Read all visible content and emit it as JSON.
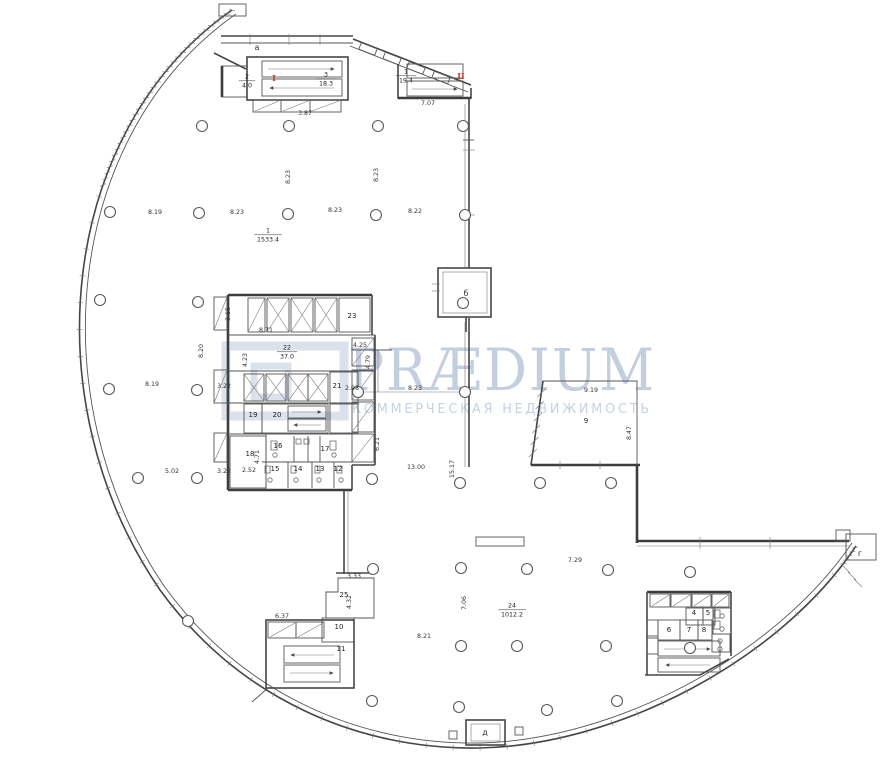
{
  "watermark": {
    "brand": "PRÆDIUM",
    "tagline": "КОММЕРЧЕСКАЯ НЕДВИЖИМОСТЬ",
    "color": "#b9c6da"
  },
  "plan": {
    "letters": [
      {
        "text": "а",
        "x": 257,
        "y": 50
      },
      {
        "text": "б",
        "x": 466,
        "y": 296
      },
      {
        "text": "г",
        "x": 860,
        "y": 556
      },
      {
        "text": "д",
        "x": 485,
        "y": 735
      }
    ],
    "red_markers": [
      {
        "text": "I",
        "x": 274,
        "y": 81
      },
      {
        "text": "II",
        "x": 461,
        "y": 79
      }
    ],
    "rooms": [
      {
        "num": "23",
        "x": 352,
        "y": 318
      },
      {
        "num": "21",
        "x": 337,
        "y": 388
      },
      {
        "num": "19",
        "x": 253,
        "y": 417
      },
      {
        "num": "20",
        "x": 277,
        "y": 417
      },
      {
        "num": "18",
        "x": 250,
        "y": 456
      },
      {
        "num": "16",
        "x": 278,
        "y": 448
      },
      {
        "num": "17",
        "x": 325,
        "y": 451
      },
      {
        "num": "15",
        "x": 275,
        "y": 471
      },
      {
        "num": "14",
        "x": 298,
        "y": 471
      },
      {
        "num": "13",
        "x": 320,
        "y": 471
      },
      {
        "num": "12",
        "x": 338,
        "y": 471
      },
      {
        "num": "25",
        "x": 344,
        "y": 597
      },
      {
        "num": "10",
        "x": 339,
        "y": 629
      },
      {
        "num": "11",
        "x": 341,
        "y": 651
      },
      {
        "num": "4",
        "x": 694,
        "y": 615
      },
      {
        "num": "5",
        "x": 708,
        "y": 615
      },
      {
        "num": "6",
        "x": 669,
        "y": 632
      },
      {
        "num": "7",
        "x": 689,
        "y": 632
      },
      {
        "num": "8",
        "x": 704,
        "y": 632
      },
      {
        "num": "9",
        "x": 586,
        "y": 423
      }
    ],
    "room_areas": [
      {
        "num": "2",
        "area": "4.0",
        "x": 247,
        "y": 80
      },
      {
        "num": "3",
        "area": "18.3",
        "x": 326,
        "y": 78
      },
      {
        "num": "1",
        "area": "19.4",
        "x": 406,
        "y": 75
      },
      {
        "num": "1",
        "area": "1533.4",
        "x": 268,
        "y": 234
      },
      {
        "num": "22",
        "area": "37.0",
        "x": 287,
        "y": 351
      },
      {
        "num": "24",
        "area": "1012.2",
        "x": 512,
        "y": 609
      }
    ],
    "dims": [
      {
        "text": "3.87",
        "x": 305,
        "y": 115
      },
      {
        "text": "7.07",
        "x": 428,
        "y": 105
      },
      {
        "text": "8.19",
        "x": 155,
        "y": 214
      },
      {
        "text": "8.23",
        "x": 237,
        "y": 214
      },
      {
        "text": "8.23",
        "x": 335,
        "y": 212
      },
      {
        "text": "8.22",
        "x": 415,
        "y": 213
      },
      {
        "text": "8.23",
        "x": 290,
        "y": 177,
        "rot": -90
      },
      {
        "text": "8.23",
        "x": 378,
        "y": 175,
        "rot": -90
      },
      {
        "text": "8.20",
        "x": 203,
        "y": 351,
        "rot": -90
      },
      {
        "text": "8.19",
        "x": 152,
        "y": 386
      },
      {
        "text": "3.22",
        "x": 224,
        "y": 388
      },
      {
        "text": "5.02",
        "x": 172,
        "y": 473
      },
      {
        "text": "3.22",
        "x": 224,
        "y": 473
      },
      {
        "text": "3.15",
        "x": 230,
        "y": 314,
        "rot": -90
      },
      {
        "text": "8.71",
        "x": 266,
        "y": 332
      },
      {
        "text": "4.23",
        "x": 247,
        "y": 360,
        "rot": -90
      },
      {
        "text": "4.25",
        "x": 360,
        "y": 347
      },
      {
        "text": "4.79",
        "x": 370,
        "y": 362,
        "rot": -90
      },
      {
        "text": "2.98",
        "x": 352,
        "y": 390
      },
      {
        "text": "8.23",
        "x": 415,
        "y": 390
      },
      {
        "text": "6.21",
        "x": 379,
        "y": 444,
        "rot": -90
      },
      {
        "text": "13.00",
        "x": 416,
        "y": 469
      },
      {
        "text": "15.17",
        "x": 454,
        "y": 469,
        "rot": -90
      },
      {
        "text": "4.71",
        "x": 259,
        "y": 457,
        "rot": -90
      },
      {
        "text": "2.52",
        "x": 249,
        "y": 472
      },
      {
        "text": "9.19",
        "x": 591,
        "y": 392
      },
      {
        "text": "8.47",
        "x": 631,
        "y": 433,
        "rot": -90
      },
      {
        "text": "7.29",
        "x": 575,
        "y": 562
      },
      {
        "text": "7.06",
        "x": 466,
        "y": 603,
        "rot": -90
      },
      {
        "text": "8.21",
        "x": 424,
        "y": 638
      },
      {
        "text": "6.37",
        "x": 282,
        "y": 618
      },
      {
        "text": "3.33",
        "x": 354,
        "y": 578
      },
      {
        "text": "4.32",
        "x": 351,
        "y": 602,
        "rot": -90
      }
    ]
  }
}
